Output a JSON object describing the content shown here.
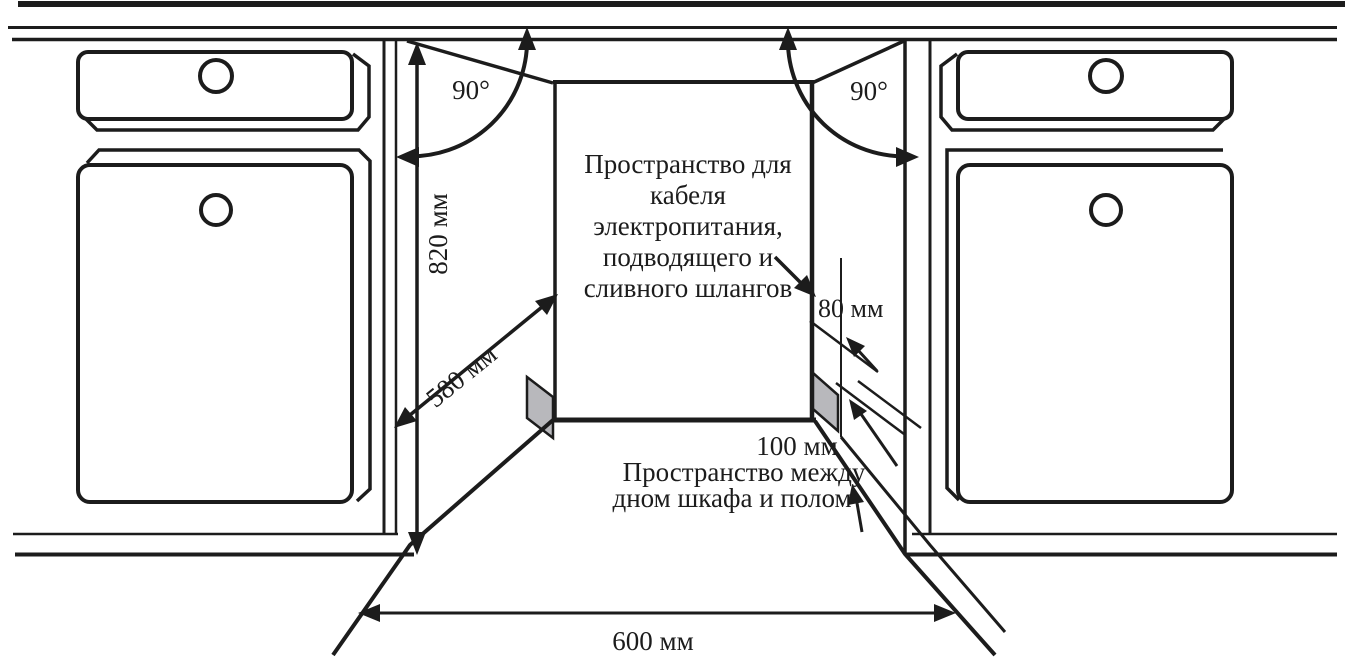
{
  "labels": {
    "angle_left": "90°",
    "angle_right": "90°",
    "height": "820 мм",
    "depth": "580 мм",
    "width": "600 мм",
    "cable_gap": "80 мм",
    "floor_gap": "100 мм"
  },
  "annotations": {
    "cable_space": {
      "lines": [
        "Пространство для",
        "кабеля",
        "электропитания,",
        "подводящего и",
        "сливного шлангов"
      ]
    },
    "floor_space": {
      "lines": [
        "Пространство между",
        "дном шкафа и полом"
      ]
    }
  },
  "colors": {
    "line": "#1c1c1c",
    "panel_gray": "#b8b8bc",
    "background": "#ffffff"
  }
}
